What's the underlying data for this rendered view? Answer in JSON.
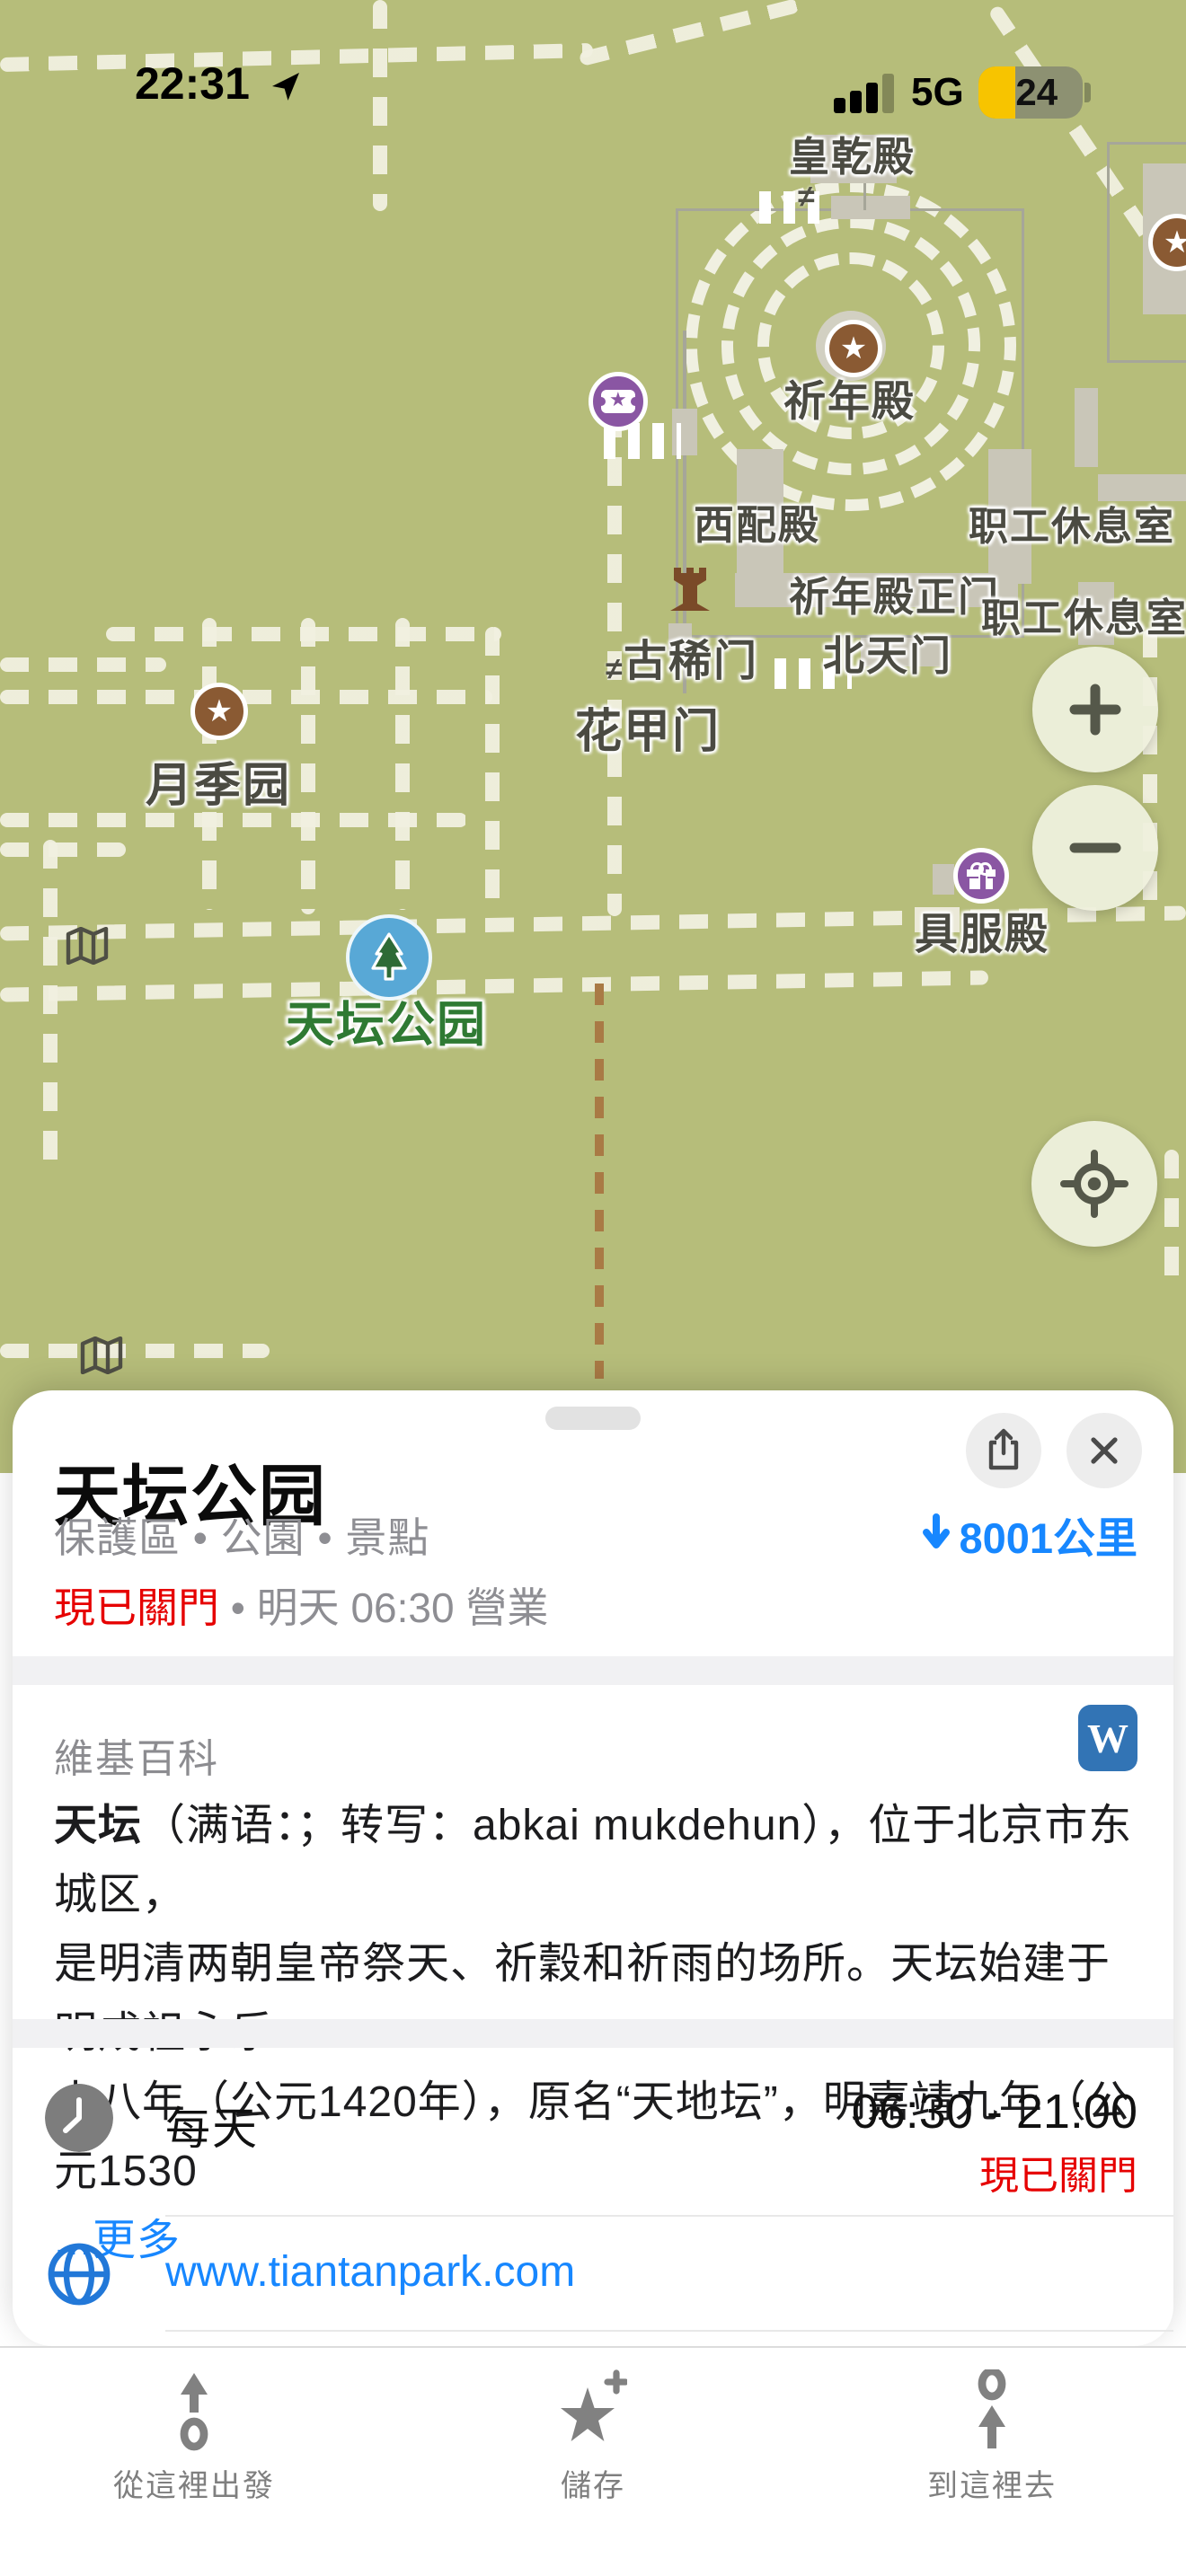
{
  "status_bar": {
    "time": "22:31",
    "network": "5G",
    "battery_percent": "24"
  },
  "map": {
    "labels": [
      {
        "text": "皇乾殿"
      },
      {
        "text": "祈年殿"
      },
      {
        "text": "西配殿"
      },
      {
        "text": "职工休息室"
      },
      {
        "text": "祈年殿正门"
      },
      {
        "text": "职工休息室"
      },
      {
        "text": "古稀门"
      },
      {
        "text": "北天门"
      },
      {
        "text": "花甲门"
      },
      {
        "text": "月季园"
      },
      {
        "text": "具服殿"
      },
      {
        "text": "天坛公园"
      }
    ],
    "temple_glyph": "≠",
    "poi_star": "★"
  },
  "sheet": {
    "title": "天坛公园",
    "category": "保護區 • 公園 • 景點",
    "distance": "8001公里",
    "status_closed": "現已關門",
    "separator": " • ",
    "opens_info": "明天 06:30 營業",
    "wiki": {
      "header": "維基百科",
      "icon_letter": "W",
      "lead": "天坛",
      "line1_rest": "（满语：；转写：abkai mukdehun），位于北京市东城区，",
      "line2": "是明清两朝皇帝祭天、祈穀和祈雨的场所。天坛始建于明成祖永乐",
      "line3": "十八年（公元1420年），原名“天地坛”，明嘉靖九年（公元1530",
      "more_link": "...更多"
    },
    "hours": {
      "day": "每天",
      "time_range": "06:30 - 21:00",
      "status": "現已關門"
    },
    "website": "www.tiantanpark.com"
  },
  "toolbar": {
    "items": [
      {
        "label": "從這裡出發"
      },
      {
        "label": "儲存"
      },
      {
        "label": "到這裡去"
      }
    ]
  },
  "colors": {
    "map_background": "#b6bd7a",
    "accent_blue": "#1787ff",
    "closed_red": "#e60000",
    "wiki_blue": "#3274b5",
    "battery_yellow": "#f7c400",
    "park_label_green": "#2f7a33",
    "poi_brown": "#8a5a33",
    "poi_purple": "#8a56a3"
  }
}
